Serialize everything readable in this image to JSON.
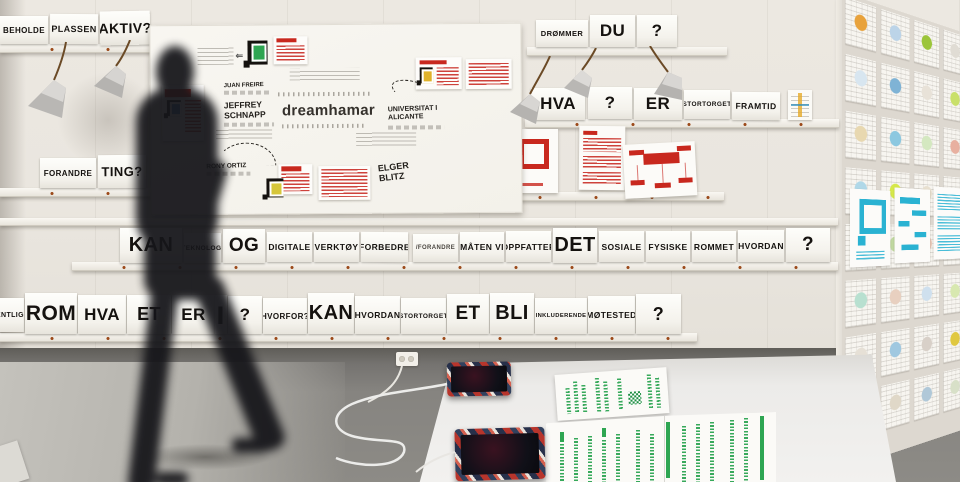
{
  "meta": {
    "scene": "dreamhamar participatory design exhibition room — word cards on wall rails, sketch whiteboard, blurred walking visitor, tablets and green posters on a white table",
    "colors": {
      "accent_red": "#c8281e",
      "accent_blue": "#2ab2d2",
      "accent_green": "#2ea552",
      "wall": "#eae6df",
      "floor": "#85827d"
    }
  },
  "rows": {
    "top_left": [
      "BEHOLDE",
      "PLASSEN",
      "AKTIV?"
    ],
    "top_right": [
      "DRØMMER",
      "DU",
      "?"
    ],
    "mid_right": [
      "HVA",
      "?",
      "ER",
      "STORTORGET",
      "FRAMTID"
    ],
    "forandre": [
      "FORANDRE",
      "TING?"
    ],
    "main": [
      "KAN",
      "TEKNOLOGI",
      "OG",
      "DIGITALE",
      "VERKTØY",
      "FORBEDRE",
      "/FORANDRE",
      "MÅTEN VI",
      "OPPFATTER",
      "DET",
      "SOSIALE",
      "FYSISKE",
      "ROMMET",
      "HVORDAN",
      "?"
    ],
    "bottom": [
      "ENTLIG",
      "ROM",
      "HVA",
      "ET",
      "ER",
      "|",
      "?",
      "HVORFOR?",
      "KAN",
      "HVORDAN",
      "STORTORGET",
      "ET",
      "BLI",
      "INKLUDERENDE",
      "MØTESTED",
      "?"
    ]
  },
  "whiteboard": {
    "logo": "dreamhamar",
    "names": {
      "juan_freire": "JUAN FREIRE",
      "jeffrey_schnapp": "JEFFREY SCHNAPP",
      "rony_ortiz": "RONY ORTIZ",
      "universitat": "UNIVERSITAT I ALICANTE",
      "elger_blitz": "ELGER BLITZ"
    }
  },
  "right_wall": {
    "cells": [
      "#e8a23c",
      "#bcd4e8",
      "#9cc53a",
      "#e0dcd4",
      "#d8e6f0",
      "#7fb3d5",
      "#e8e2d8",
      "#c9e06a",
      "#e8d8b0",
      "#8cc8e0",
      "#d4e8c0",
      "#e8b0a0",
      "#b0d8e8",
      "#d6e84a",
      "#e8e0d0",
      "#a8d0e0",
      "#e0e8d8",
      "#c0d8a0",
      "#e8c8b8",
      "#d0e0e8",
      "#b8e0d0",
      "#e8d0c0",
      "#cfe0ee",
      "#d8e8b0",
      "#e6e0d6",
      "#a0c8e0",
      "#d8d0c8",
      "#e0c840",
      "#c8e0d8",
      "#e0d8c8",
      "#b0c8d8",
      "#d8e0c8"
    ]
  }
}
